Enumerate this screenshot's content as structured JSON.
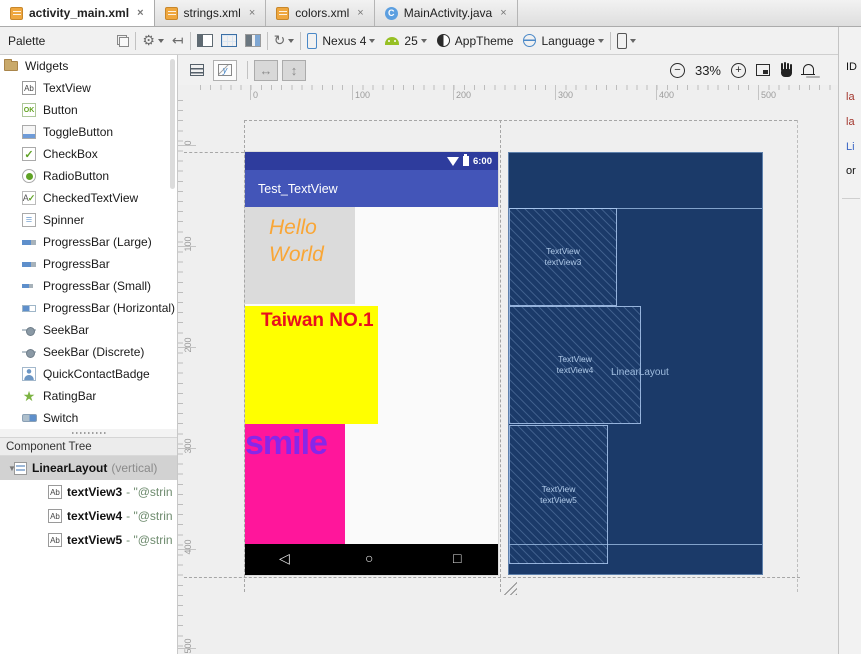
{
  "tabs": [
    {
      "label": "activity_main.xml",
      "icon": "xml-file-icon",
      "active": true
    },
    {
      "label": "strings.xml",
      "icon": "xml-file-icon",
      "active": false
    },
    {
      "label": "colors.xml",
      "icon": "xml-file-icon",
      "active": false
    },
    {
      "label": "MainActivity.java",
      "icon": "java-class-icon",
      "active": false
    }
  ],
  "ui": {
    "close": "×",
    "java_badge": "C"
  },
  "toolbar": {
    "palette_title": "Palette",
    "device": "Nexus 4",
    "api_level": "25",
    "theme": "AppTheme",
    "language": "Language",
    "gear_glyph": "⚙",
    "pin_glyph": "↤",
    "rotate_glyph": "↻"
  },
  "design_toolbar": {
    "zoom_out": "−",
    "zoom_level": "33%",
    "zoom_in": "+",
    "h_arrow": "↔",
    "v_arrow": "↕"
  },
  "palette": {
    "group": "Widgets",
    "items": [
      {
        "label": "TextView",
        "icon": "textview-icon"
      },
      {
        "label": "Button",
        "icon": "button-icon"
      },
      {
        "label": "ToggleButton",
        "icon": "togglebutton-icon"
      },
      {
        "label": "CheckBox",
        "icon": "checkbox-icon"
      },
      {
        "label": "RadioButton",
        "icon": "radiobutton-icon"
      },
      {
        "label": "CheckedTextView",
        "icon": "checkedtextview-icon"
      },
      {
        "label": "Spinner",
        "icon": "spinner-icon"
      },
      {
        "label": "ProgressBar (Large)",
        "icon": "progressbar-icon"
      },
      {
        "label": "ProgressBar",
        "icon": "progressbar-icon"
      },
      {
        "label": "ProgressBar (Small)",
        "icon": "progressbar-small-icon"
      },
      {
        "label": "ProgressBar (Horizontal)",
        "icon": "progressbar-horizontal-icon"
      },
      {
        "label": "SeekBar",
        "icon": "seekbar-icon"
      },
      {
        "label": "SeekBar (Discrete)",
        "icon": "seekbar-icon"
      },
      {
        "label": "QuickContactBadge",
        "icon": "quickcontactbadge-icon"
      },
      {
        "label": "RatingBar",
        "icon": "ratingbar-icon"
      },
      {
        "label": "Switch",
        "icon": "switch-icon"
      }
    ]
  },
  "component_tree": {
    "title": "Component Tree",
    "root": "LinearLayout",
    "root_suffix": "(vertical)",
    "expand_glyph": "▼",
    "children": [
      {
        "name": "textView3",
        "value": "- \"@strin"
      },
      {
        "name": "textView4",
        "value": "- \"@strin"
      },
      {
        "name": "textView5",
        "value": "- \"@strin"
      }
    ]
  },
  "rulers": {
    "h": [
      "0",
      "100",
      "200",
      "300",
      "400",
      "500"
    ],
    "v": [
      "0",
      "100",
      "200",
      "300",
      "400",
      "500"
    ]
  },
  "screen": {
    "time": "6:00",
    "title": "Test_TextView",
    "hello_lines": [
      "Hello",
      "World"
    ],
    "taiwan": "Taiwan NO.1",
    "smile": "smile",
    "nav": {
      "back_icon": "◁",
      "home_icon": "○",
      "recents_icon": "□"
    }
  },
  "blueprint": {
    "container_label": "LinearLayout",
    "blocks": [
      [
        "TextView",
        "textView3"
      ],
      [
        "TextView",
        "textView4"
      ],
      [
        "TextView",
        "textView5"
      ]
    ]
  },
  "props_panel": {
    "header": "Pr",
    "rows": [
      "ID",
      "la",
      "la",
      "Li",
      "or"
    ]
  },
  "colors": {
    "status_bar": "#2E3C9D",
    "app_bar": "#4355B8",
    "hello_bg": "#DBDBDB",
    "hello_text": "#F9A636",
    "taiwan_bg": "#FFFF00",
    "taiwan_text": "#E8101E",
    "smile_bg": "#FF169B",
    "smile_text": "#8727E9",
    "nav_bar": "#000000",
    "blueprint_bg": "#1B3A69"
  }
}
